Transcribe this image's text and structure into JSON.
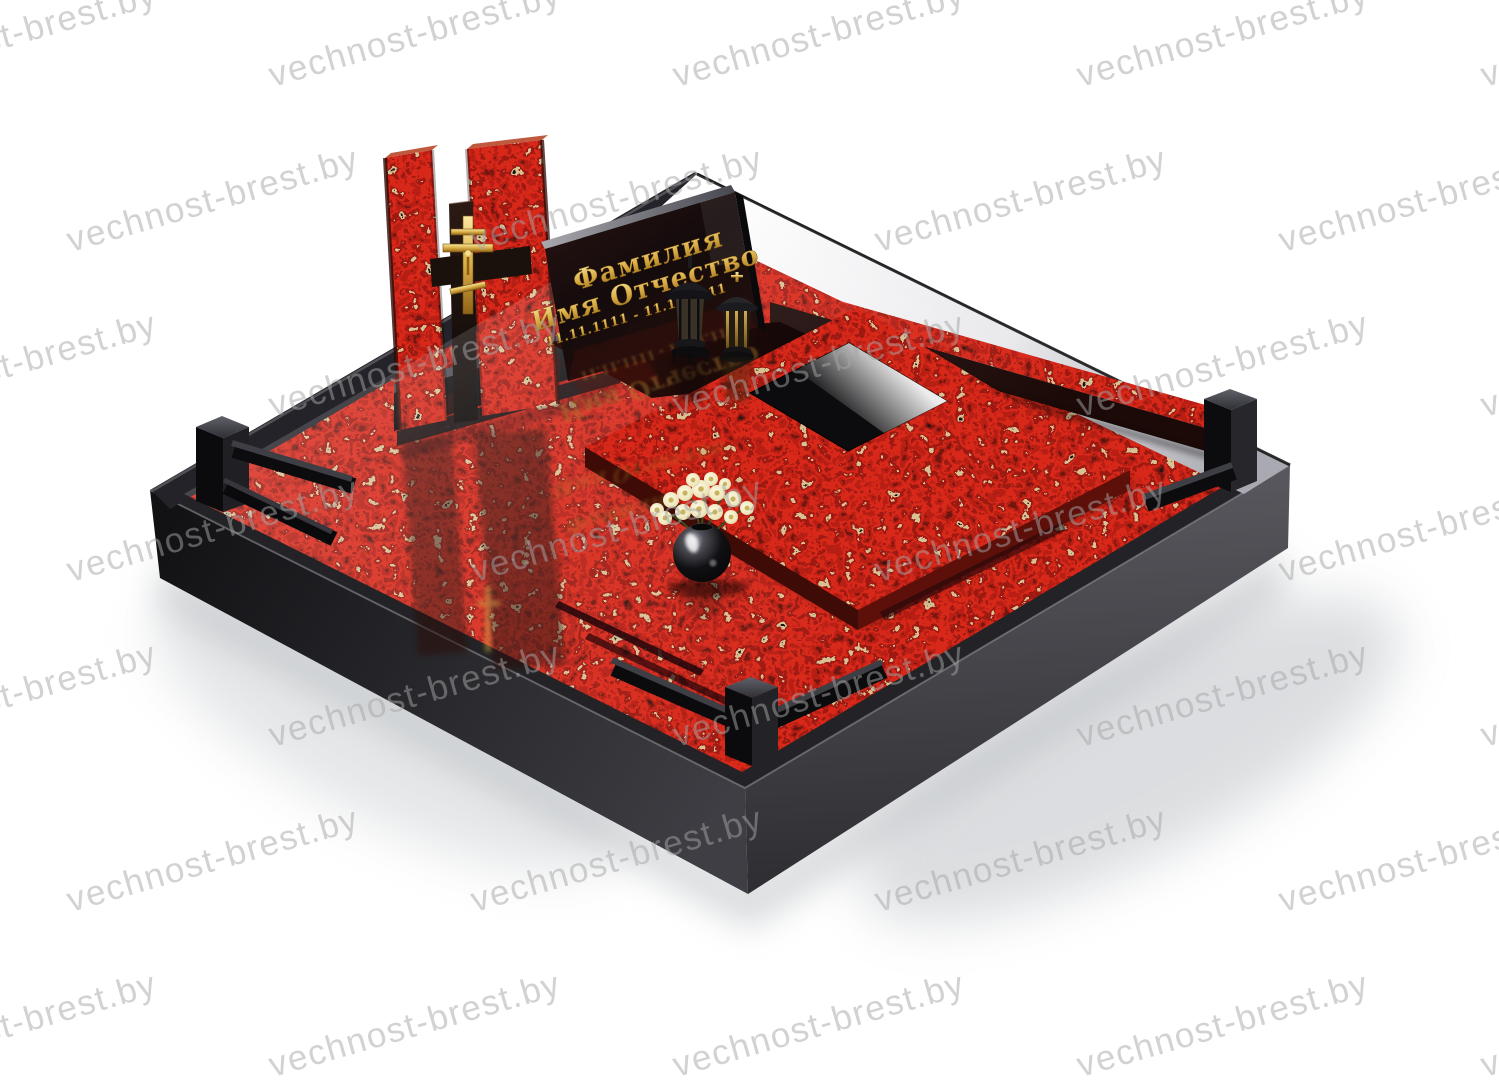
{
  "page": {
    "background": "#ffffff",
    "width": 1499,
    "height": 1080
  },
  "watermark": {
    "text": "vechnost-brest.by",
    "color": "#a6a6a6",
    "opacity": 0.5,
    "angle_deg": -16,
    "font_size": 35
  },
  "monument": {
    "plaque": {
      "surname": "Фамилия",
      "name_patronymic": "Имя Отчество",
      "dates": "11.11.1111 - 11.11.1111"
    },
    "colors": {
      "granite_red": "#b03020",
      "granite_red_dark": "#5c1008",
      "granite_speckle": "#d8c9a4",
      "granite_black_patch": "#1c100c",
      "black_granite": "#141417",
      "gold": "#dfb54f",
      "flowers_cream": "#efe8c4",
      "flower_center": "#c9b45e",
      "vase_black": "#0a0a0b"
    }
  }
}
